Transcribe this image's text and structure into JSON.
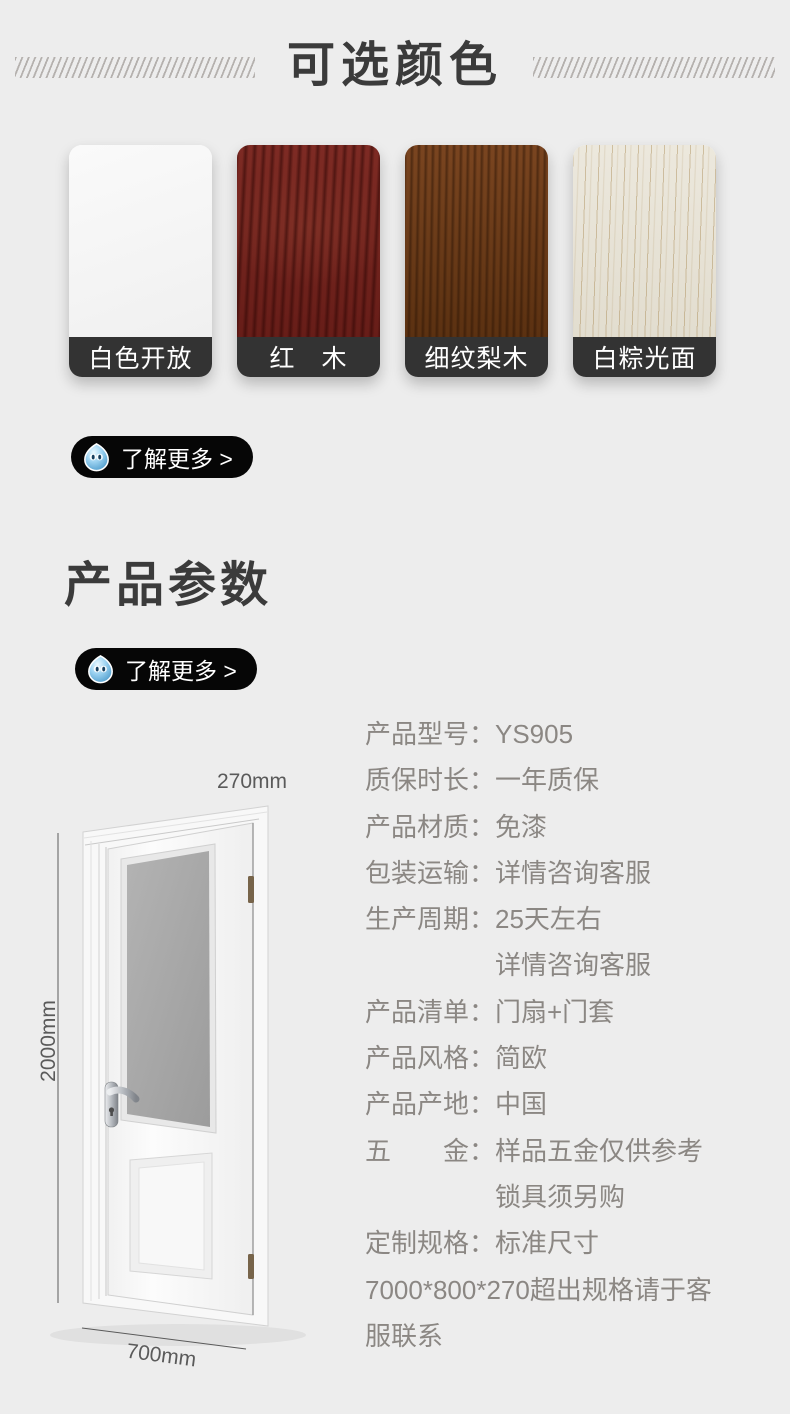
{
  "page": {
    "background": "#ededed"
  },
  "colors_section": {
    "title": "可选颜色",
    "swatches": [
      {
        "label": "白色开放",
        "texture": "white",
        "color": "#f6f6f6"
      },
      {
        "label": "红　木",
        "texture": "redwood",
        "color": "#7a2823"
      },
      {
        "label": "细纹梨木",
        "texture": "pearwood",
        "color": "#6e3a17"
      },
      {
        "label": "白粽光面",
        "texture": "whiteoak",
        "color": "#e9e4d8"
      }
    ],
    "label_bar_color": "#333333",
    "more_button": {
      "label": "了解更多 >",
      "icon": "water-drop-icon",
      "color": "#060606"
    }
  },
  "params_section": {
    "title": "产品参数",
    "more_button": {
      "label": "了解更多 >",
      "icon": "water-drop-icon",
      "color": "#060606"
    },
    "door": {
      "top_dim": "270mm",
      "side_dim": "2000mm",
      "bottom_dim": "700mm"
    },
    "specs": [
      {
        "type": "pair",
        "label": "产品型号",
        "colon": "：",
        "value": "YS905"
      },
      {
        "type": "pair",
        "label": "质保时长",
        "colon": "：",
        "value": "一年质保"
      },
      {
        "type": "pair",
        "label": "产品材质",
        "colon": "：",
        "value": "免漆"
      },
      {
        "type": "pair",
        "label": "包装运输",
        "colon": "：",
        "value": "详情咨询客服"
      },
      {
        "type": "pair",
        "label": "生产周期",
        "colon": "：",
        "value": "25天左右"
      },
      {
        "type": "cont",
        "value": "详情咨询客服"
      },
      {
        "type": "pair",
        "label": "产品清单",
        "colon": "：",
        "value": "门扇+门套"
      },
      {
        "type": "pair",
        "label": "产品风格",
        "colon": "：",
        "value": "简欧"
      },
      {
        "type": "pair",
        "label": "产品产地",
        "colon": "：",
        "value": "中国"
      },
      {
        "type": "pair",
        "label": "五金",
        "colon": "：",
        "value": "样品五金仅供参考"
      },
      {
        "type": "cont",
        "value": "锁具须另购"
      },
      {
        "type": "pair",
        "label": "定制规格",
        "colon": "：",
        "value": "标准尺寸"
      },
      {
        "type": "free",
        "value": "7000*800*270超出规格请于客"
      },
      {
        "type": "free",
        "value": "服联系"
      }
    ]
  }
}
